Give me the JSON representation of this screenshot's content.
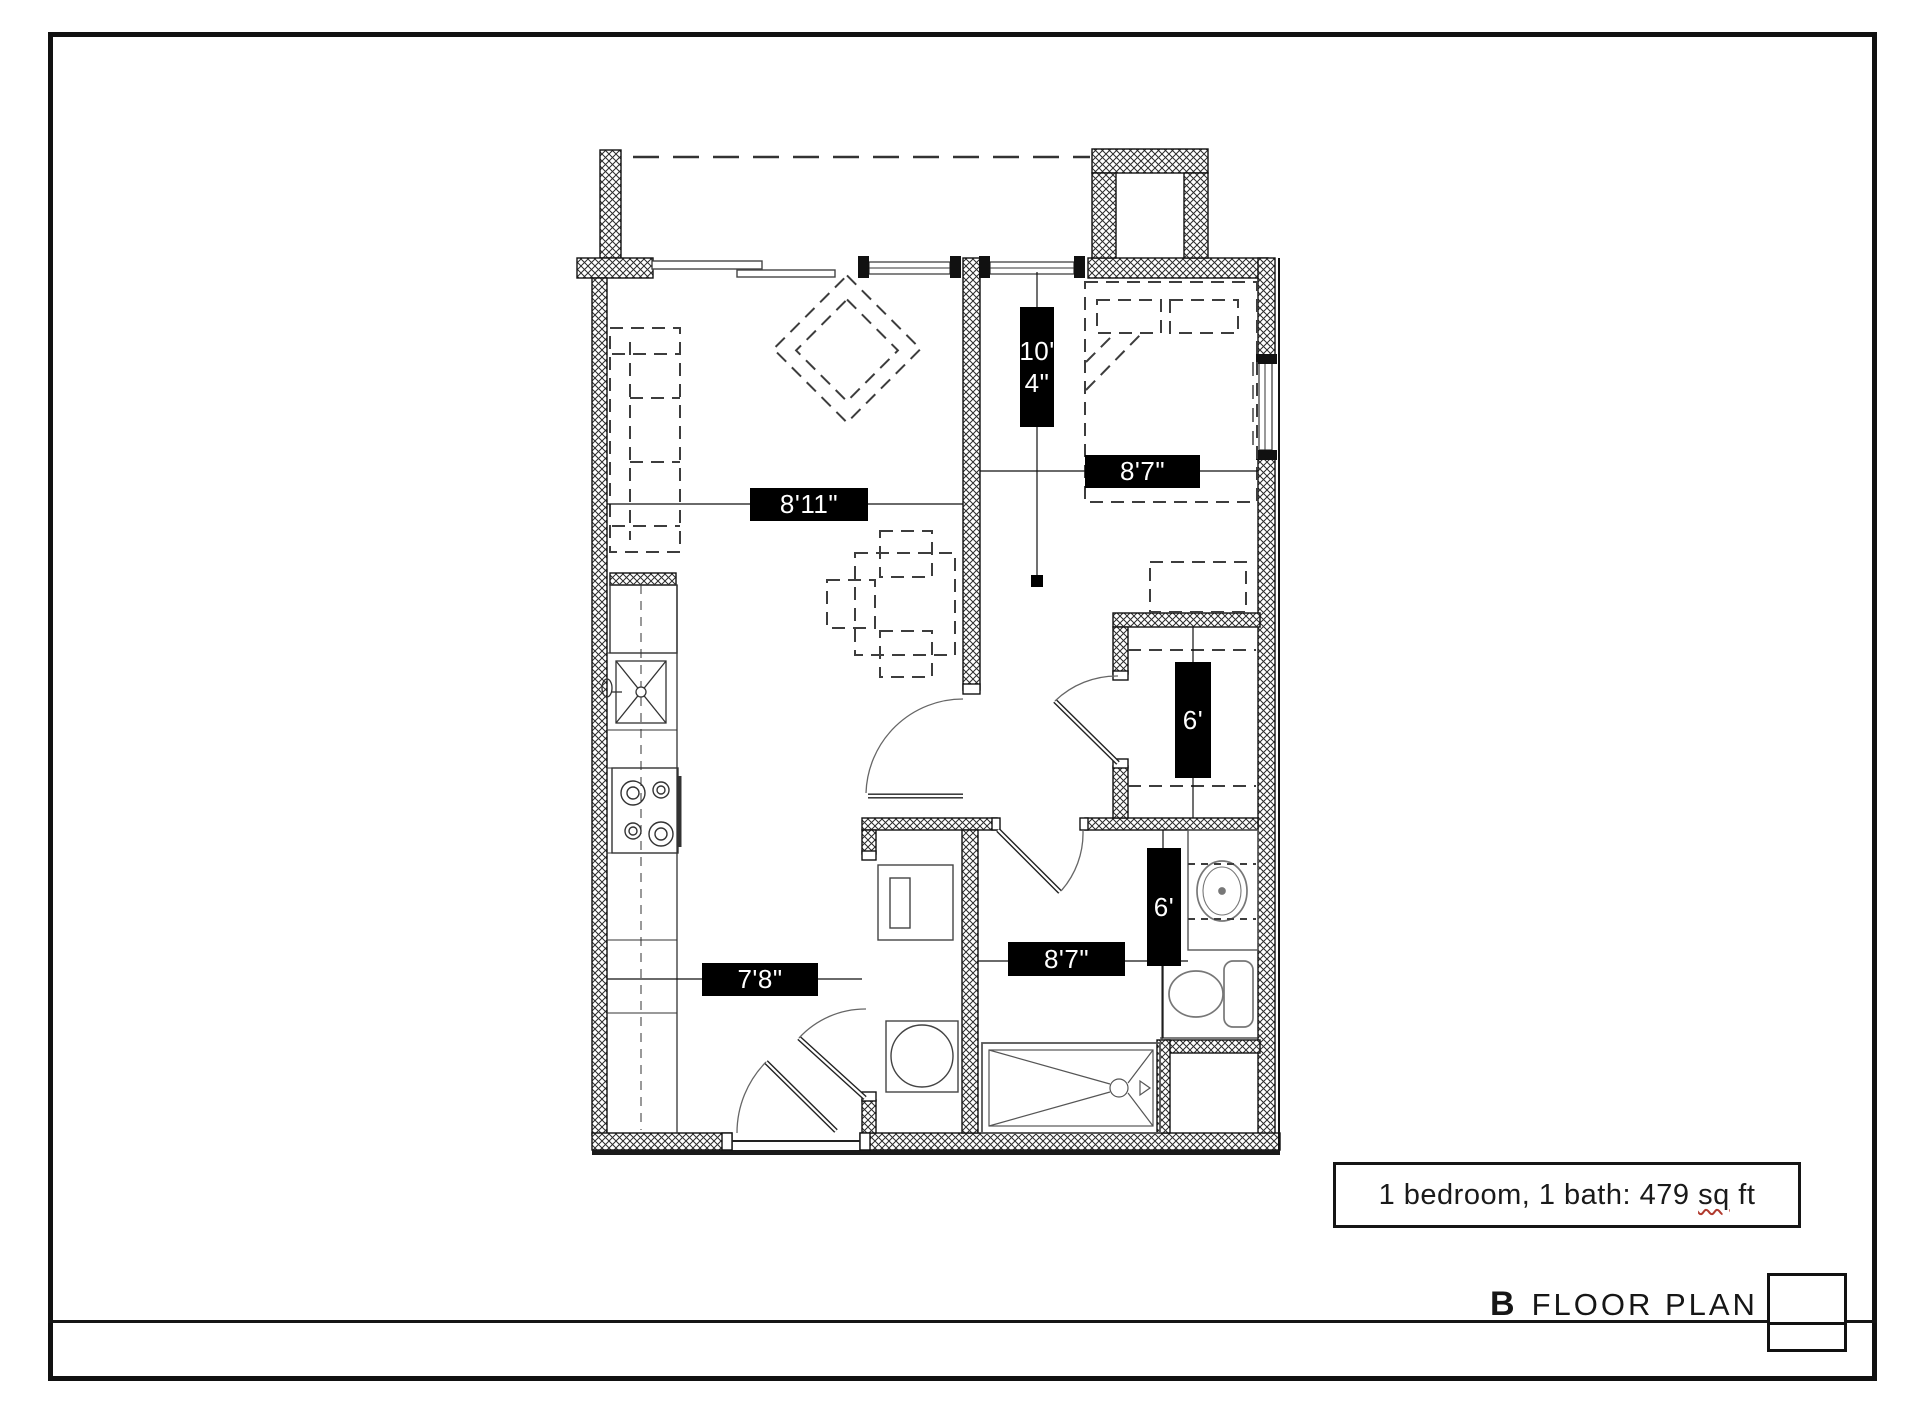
{
  "sheet": {
    "summary": {
      "text_start": "1 bedroom, 1 bath: 479 ",
      "misspelled_word": "sq",
      "text_end": " ft"
    },
    "title": {
      "plan_letter": "B",
      "plan_name": "FLOOR PLAN"
    }
  },
  "dimensions": {
    "bedroom_vertical_line1": "10'",
    "bedroom_vertical_line2": "4\"",
    "bedroom_horizontal": "8'7\"",
    "living_horizontal": "8'11\"",
    "closet_vertical": "6'",
    "bath_vertical": "6'",
    "bath_horizontal": "8'7\"",
    "kitchen_horizontal": "7'8\""
  },
  "colors": {
    "label_background": "#000000",
    "label_text": "#ffffff",
    "line_color": "#1a1a1a",
    "squiggle_color": "#b03a2e"
  }
}
